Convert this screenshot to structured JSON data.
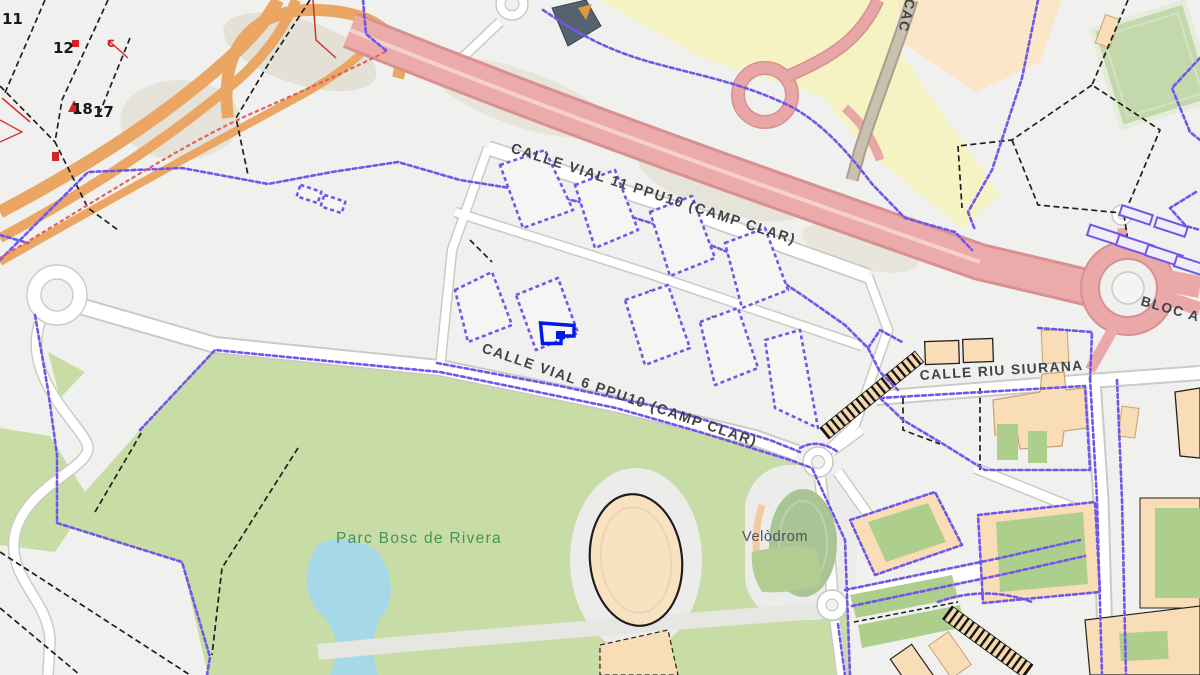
{
  "page": {
    "type": "gis-map-viewer",
    "description": "Cadastral and urban planning web map with purple planning boundaries, cadastral parcels and a selected parcel highlighted in blue"
  },
  "labels": {
    "street_vial11": "CALLE VIAL 11 PPU10 (CAMP CLAR)",
    "street_vial6": "CALLE VIAL 6 PPU10 (CAMP CLAR)",
    "street_riu_siurana": "CALLE RIU SIURANA",
    "street_bloc_a": "BLOC A",
    "street_cac": "CAC",
    "park": "Parc Bosc de Rivera",
    "velodrome": "Velòdrom",
    "parcel_11": "11",
    "parcel_12": "12",
    "parcel_18": "18",
    "parcel_17": "17",
    "red_letter_c": "c"
  },
  "colors": {
    "background": "#f0f1ef",
    "planning_boundary_purple": "#7157e8",
    "highway_pink": "#ecabab",
    "ramp_orange": "#eaa662",
    "park_green": "#c8dda6",
    "sports_field_green": "#c3d8ab",
    "building_orange": "#f8ddb6",
    "courtyard_green": "#aecf8c",
    "water_blue": "#a5d9e8",
    "road_white": "#ffffff",
    "cadastral_black": "#1a1a1a",
    "cadastral_red": "#d83030",
    "selection_blue": "#0019e6",
    "street_label_gray": "#3f4347",
    "park_label_green": "#46925c"
  },
  "selection": {
    "feature": "parcel",
    "outline_color": "#0019e6"
  }
}
